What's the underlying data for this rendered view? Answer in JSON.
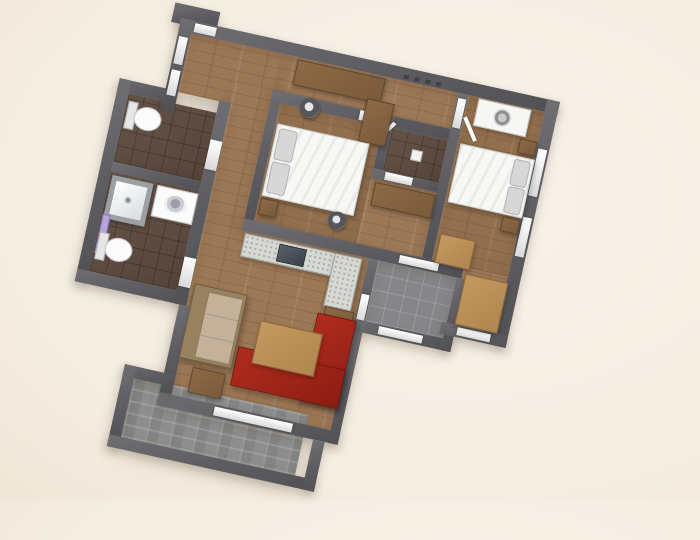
{
  "scene": {
    "description": "3D rendered top-down floor plan of a two-bedroom apartment, rotated clockwise on a cream background",
    "rotation_deg": 12.5,
    "no_visible_text": true
  },
  "colors": {
    "bg": "#f4ede1",
    "bgLight": "#f8f2e9",
    "bgDark": "#efe6d6",
    "wall": "#5c5c61",
    "wallLight": "#6e6e73",
    "wood": "#9d7856",
    "midWood": "#8d6a46",
    "lightWood": "#c49a60",
    "tileDark": "#5d4a3e",
    "greyTile": "#86868a",
    "paving": "#8d8d8d",
    "white": "#f7f7f5",
    "pillow": "#d7d7d7",
    "red": "#b12c1e",
    "redDark": "#8c1d13",
    "beige": "#c3b299",
    "beigeFrame": "#97815f",
    "granite": "#d6d8d2",
    "sinkDark": "#3b4149",
    "purple": "#b5a4dd",
    "chair": "#55555a"
  },
  "rooms": [
    {
      "name": "entry-hall",
      "floor": "wood",
      "furniture": [
        "desk",
        "desk-return",
        "office-chair",
        "wall-hooks"
      ]
    },
    {
      "name": "wc",
      "floor": "dark-tile",
      "furniture": [
        "toilet"
      ]
    },
    {
      "name": "bathroom",
      "floor": "dark-tile",
      "furniture": [
        "shower",
        "sink-counter",
        "toilet",
        "radiator"
      ]
    },
    {
      "name": "bedroom-1",
      "floor": "wood",
      "furniture": [
        "double-bed",
        "two-pillows",
        "bedside-table",
        "desk-chair"
      ]
    },
    {
      "name": "closet",
      "floor": "dark-tile",
      "furniture": [
        "small-white-item"
      ]
    },
    {
      "name": "dressing-nook",
      "floor": "wood",
      "furniture": [
        "cabinet"
      ]
    },
    {
      "name": "bedroom-2",
      "floor": "wood",
      "furniture": [
        "double-bed",
        "two-pillows",
        "bedside-tables",
        "white-dresser",
        "wardrobe-panels"
      ]
    },
    {
      "name": "living-room",
      "floor": "wood",
      "furniture": [
        "kitchen-counter-l",
        "kitchen-sink",
        "red-corner-sofa",
        "coffee-table",
        "beige-sofa",
        "side-tables"
      ]
    },
    {
      "name": "balcony",
      "floor": "grey-tile",
      "furniture": []
    },
    {
      "name": "terrace",
      "floor": "paving",
      "furniture": []
    }
  ]
}
